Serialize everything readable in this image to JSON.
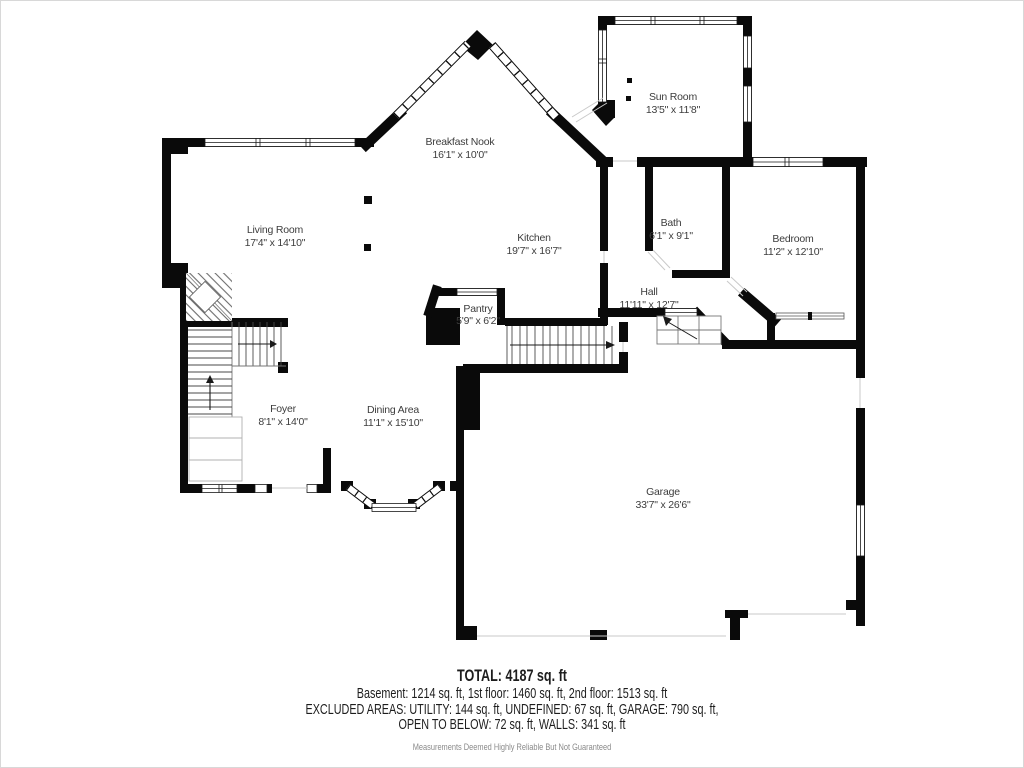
{
  "plan": {
    "rooms": [
      {
        "name": "Sun Room",
        "dims": "13'5\" x 11'8\""
      },
      {
        "name": "Breakfast Nook",
        "dims": "16'1\" x 10'0\""
      },
      {
        "name": "Living Room",
        "dims": "17'4\" x 14'10\""
      },
      {
        "name": "Kitchen",
        "dims": "19'7\" x 16'7\""
      },
      {
        "name": "Bath",
        "dims": "6'1\" x 9'1\""
      },
      {
        "name": "Bedroom",
        "dims": "11'2\" x 12'10\""
      },
      {
        "name": "Hall",
        "dims": "11'11\" x 12'7\""
      },
      {
        "name": "Pantry",
        "dims": "5'9\" x 6'2\""
      },
      {
        "name": "Foyer",
        "dims": "8'1\" x 14'0\""
      },
      {
        "name": "Dining Area",
        "dims": "11'1\" x 15'10\""
      },
      {
        "name": "Garage",
        "dims": "33'7\" x 26'6\""
      }
    ],
    "colors": {
      "wall": "#0a0a0a",
      "label": "#3d3d3d",
      "opening": "#c9c9c9",
      "stairs": "#4a4a4a"
    }
  },
  "footer": {
    "total": "TOTAL: 4187 sq. ft",
    "floors": "Basement: 1214 sq. ft, 1st floor: 1460 sq. ft, 2nd floor: 1513 sq. ft",
    "excluded_line1": "EXCLUDED AREAS: UTILITY: 144 sq. ft, UNDEFINED: 67 sq. ft, GARAGE: 790 sq. ft,",
    "excluded_line2": "OPEN TO BELOW: 72 sq. ft, WALLS: 341 sq. ft",
    "disclaimer": "Measurements Deemed Highly Reliable But Not Guaranteed"
  }
}
